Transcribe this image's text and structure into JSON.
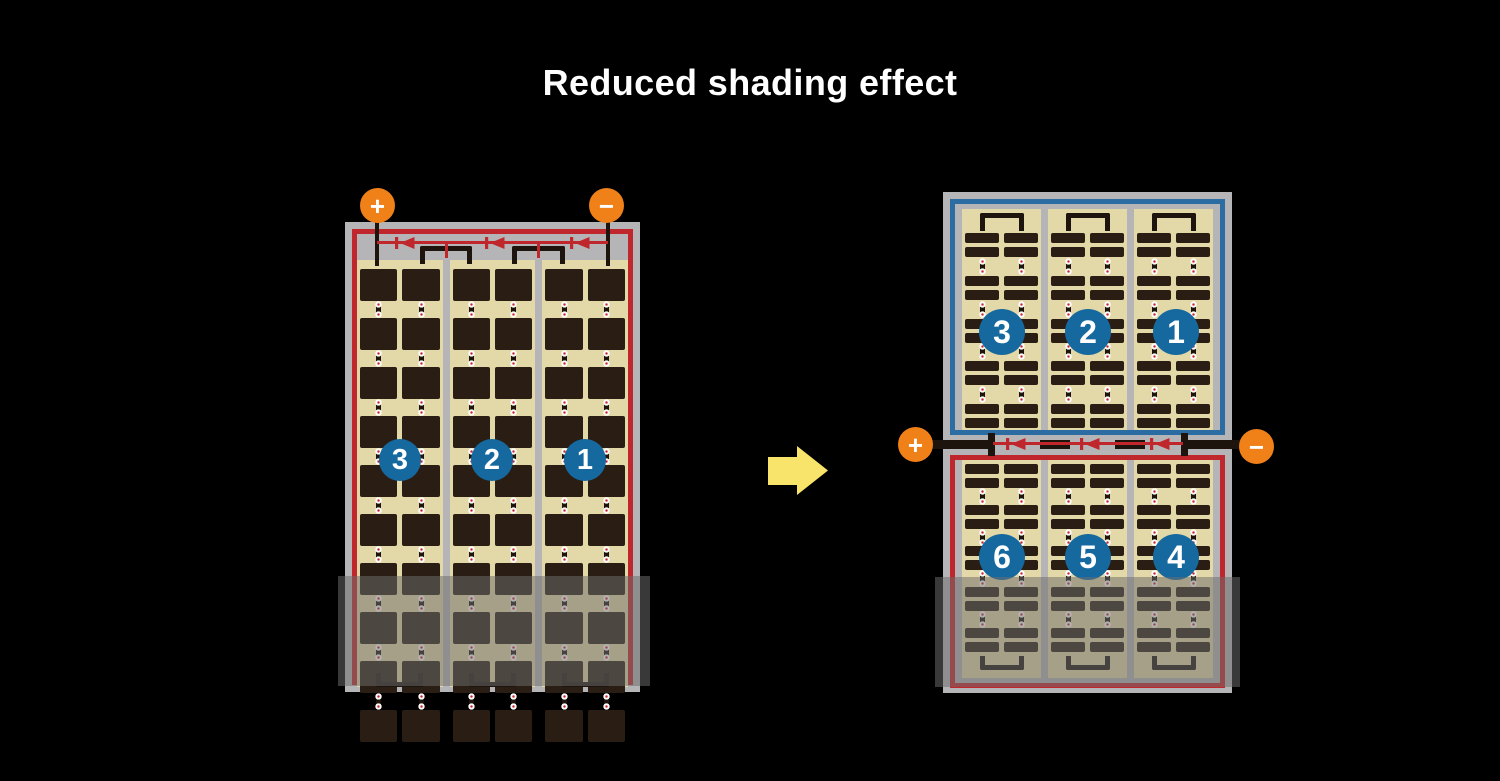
{
  "title": "Reduced shading effect",
  "colors": {
    "background": "#000000",
    "frame_gray": "#b5b4b6",
    "tan": "#e3d8a7",
    "cell_dark": "#2a1e14",
    "wire_black": "#1c140d",
    "red": "#c0272d",
    "blue": "#2b6ca3",
    "circle_blue": "#16699f",
    "orange": "#f08119",
    "arrow_yellow": "#f8e36b",
    "dot_red": "#cc2027",
    "shade": "rgba(110,110,110,0.52)"
  },
  "left_panel": {
    "terminals": {
      "positive": "+",
      "negative": "−"
    },
    "strings": [
      "3",
      "2",
      "1"
    ],
    "columns": 3,
    "subcolumns_per_column": 2,
    "cell_rows": 10,
    "bypass_diodes": 3
  },
  "right_panel": {
    "terminals": {
      "positive": "+",
      "negative": "−"
    },
    "top_half_strings": [
      "3",
      "2",
      "1"
    ],
    "bottom_half_strings": [
      "6",
      "5",
      "4"
    ],
    "columns": 3,
    "subcolumns_per_column": 2,
    "bar_pairs_per_half": 5,
    "bypass_diodes": 3
  }
}
